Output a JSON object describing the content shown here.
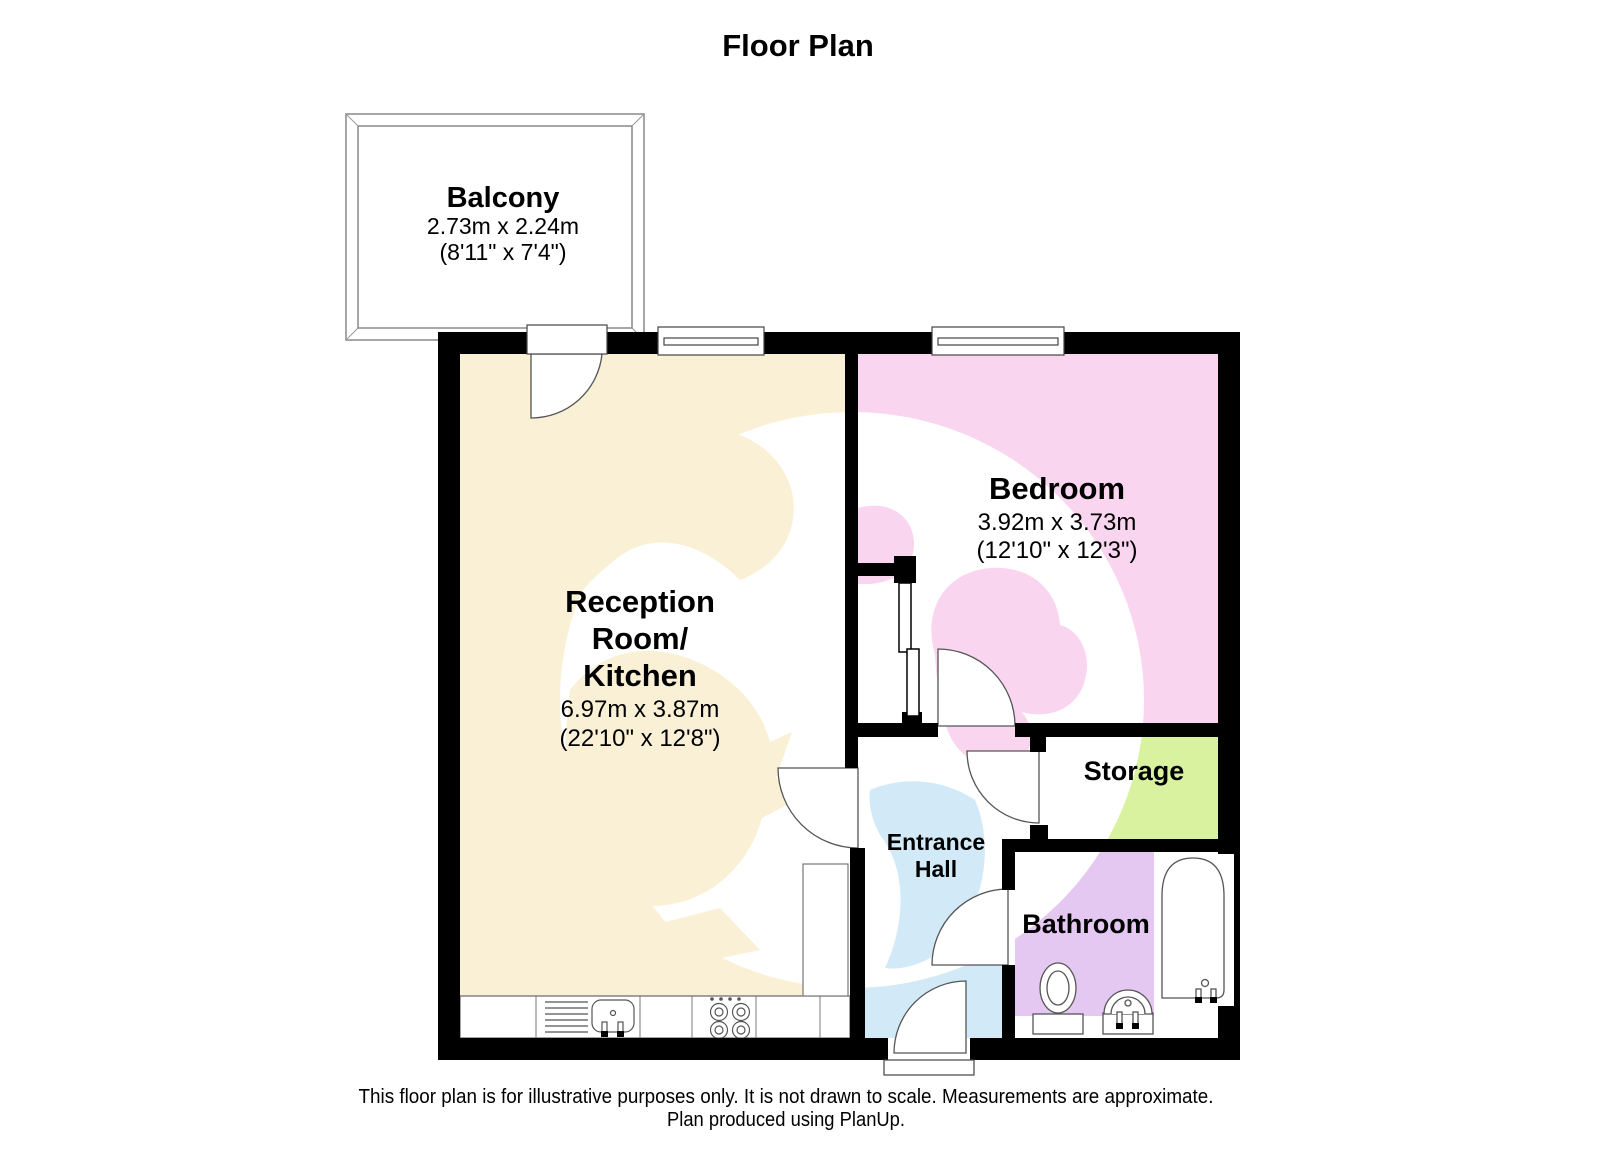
{
  "title": "Floor Plan",
  "colors": {
    "wall": "#000000",
    "reception": "#FAF0D5",
    "bedroom": "#F9D5EF",
    "entrance_hall": "#D2EAF8",
    "storage": "#D9F2A0",
    "bathroom": "#E5C8F2",
    "watermark": "#FFFFFF",
    "fixture_outline": "#555555"
  },
  "rooms": {
    "balcony": {
      "name": "Balcony",
      "dimensions_metric": "2.73m x 2.24m",
      "dimensions_imperial": "(8'11\" x 7'4\")"
    },
    "reception": {
      "name_line1": "Reception",
      "name_line2": "Room/",
      "name_line3": "Kitchen",
      "dimensions_metric": "6.97m x 3.87m",
      "dimensions_imperial": "(22'10\" x 12'8\")"
    },
    "bedroom": {
      "name": "Bedroom",
      "dimensions_metric": "3.92m x 3.73m",
      "dimensions_imperial": "(12'10\" x 12'3\")"
    },
    "entrance_hall": {
      "name_line1": "Entrance",
      "name_line2": "Hall"
    },
    "storage": {
      "name": "Storage"
    },
    "bathroom": {
      "name": "Bathroom"
    }
  },
  "footer": {
    "line1": "This floor plan is for illustrative purposes only. It is not drawn to scale. Measurements are approximate.",
    "line2": "Plan produced using PlanUp."
  }
}
